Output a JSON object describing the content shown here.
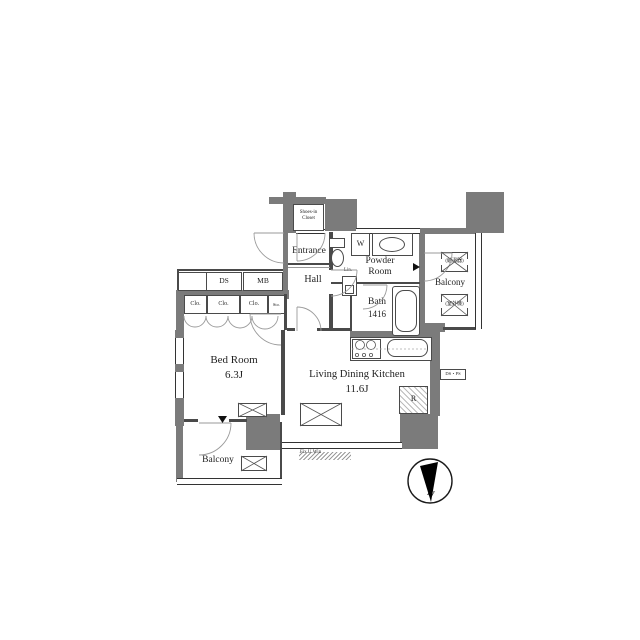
{
  "rooms": {
    "bedroom_name": "Bed Room",
    "bedroom_size": "6.3J",
    "ldk_name": "Living Dining Kitchen",
    "ldk_size": "11.6J",
    "entrance": "Entrance",
    "hall": "Hall",
    "powder_line1": "Powder",
    "powder_line2": "Room",
    "bath_name": "Bath",
    "bath_size": "1416",
    "balcony_right": "Balcony",
    "balcony_left": "Balcony",
    "shoes_closet_line1": "Shoes-in",
    "shoes_closet_line2": "Closet"
  },
  "labels": {
    "ds": "DS",
    "mb": "MB",
    "clo_1": "Clo.",
    "clo_2": "Clo.",
    "clo_3": "Clo.",
    "sto": "Sto.",
    "washer": "W",
    "linen": "Lin.",
    "fridge": "R",
    "ds_ps": "DS・PS",
    "fix_window": "Fix U.Win",
    "water_heater": "(給湯器)",
    "outdoor_unit": "(室外機)",
    "compass_north": "N"
  },
  "colors": {
    "wall": "#7b7b7b",
    "line": "#4a4a4a",
    "text": "#1f1f1f",
    "background": "#ffffff"
  }
}
